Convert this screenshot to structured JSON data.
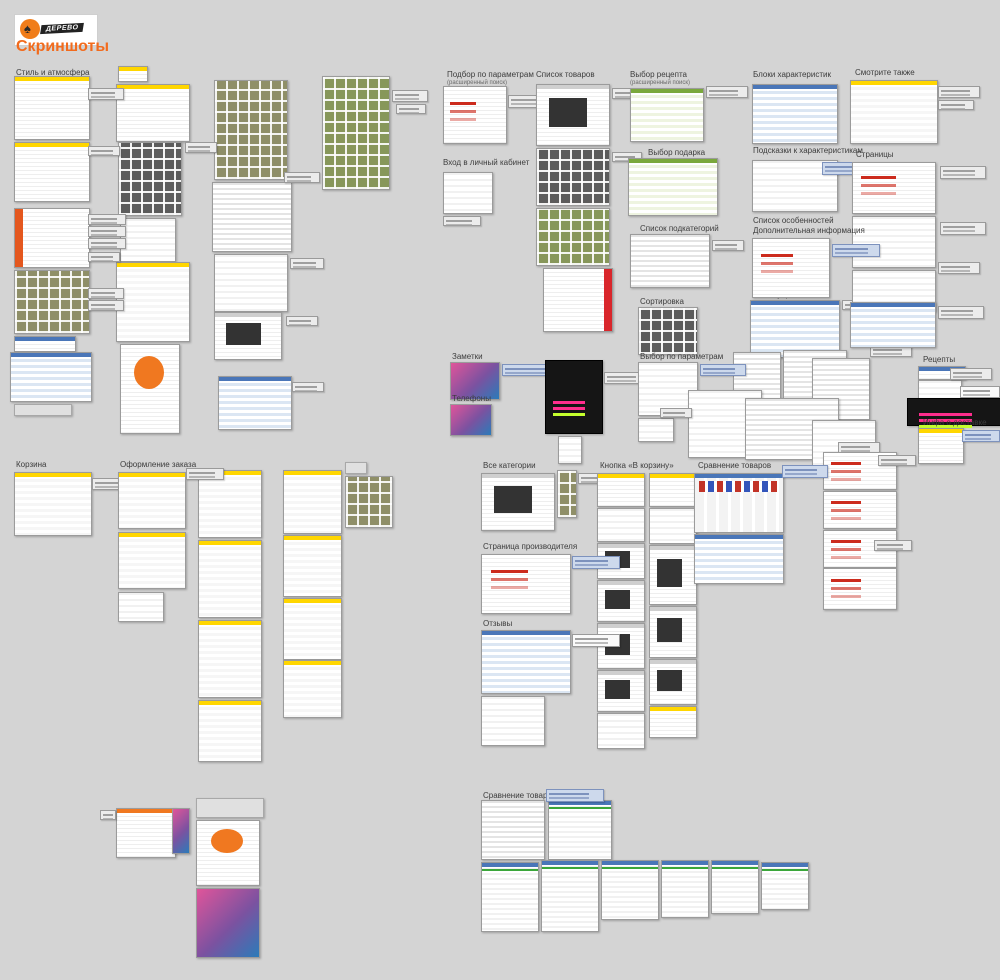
{
  "header": {
    "title": "Скриншоты",
    "logo": {
      "text": "ДЕРЕВО",
      "icon": "tree-icon"
    }
  },
  "colors": {
    "background": "#d4d4d4",
    "accent_orange": "#f26b1d",
    "yellow_header": "#ffd600",
    "blue_header": "#4a76b8",
    "green_banner": "#7aa83c",
    "note_gray": "#ececec",
    "note_blue": "#cdd9ec"
  },
  "groups": [
    {
      "id": "style",
      "label": "Стиль и атмосфера",
      "label_x": 16,
      "label_y": 68,
      "thumbs": [
        [
          14,
          76,
          74,
          62,
          "y"
        ],
        [
          14,
          142,
          74,
          58,
          "y"
        ],
        [
          14,
          208,
          74,
          58,
          "rbl"
        ],
        [
          14,
          270,
          74,
          62,
          "g"
        ],
        [
          14,
          336,
          60,
          14,
          "b"
        ],
        [
          10,
          352,
          80,
          48,
          "bt"
        ],
        [
          14,
          404,
          56,
          10,
          "s"
        ],
        [
          118,
          66,
          28,
          14,
          "y"
        ],
        [
          116,
          84,
          72,
          56,
          "y"
        ],
        [
          118,
          142,
          62,
          72,
          "gp"
        ],
        [
          120,
          218,
          54,
          42,
          "w"
        ],
        [
          116,
          262,
          72,
          78,
          "yl"
        ],
        [
          120,
          344,
          58,
          88,
          "ob"
        ],
        [
          214,
          80,
          72,
          98,
          "g"
        ],
        [
          212,
          182,
          78,
          68,
          "wt"
        ],
        [
          214,
          254,
          72,
          56,
          "w"
        ],
        [
          214,
          312,
          66,
          46,
          "d"
        ],
        [
          218,
          376,
          72,
          52,
          "bt"
        ],
        [
          322,
          76,
          66,
          112,
          "gt"
        ]
      ],
      "notes": [
        [
          88,
          88,
          34,
          10,
          "n"
        ],
        [
          88,
          146,
          30,
          8,
          "n"
        ],
        [
          88,
          214,
          36,
          9,
          "n"
        ],
        [
          88,
          226,
          36,
          9,
          "n"
        ],
        [
          88,
          238,
          36,
          9,
          "n"
        ],
        [
          88,
          252,
          30,
          8,
          "n"
        ],
        [
          88,
          288,
          34,
          9,
          "n"
        ],
        [
          88,
          300,
          34,
          9,
          "n"
        ],
        [
          185,
          142,
          30,
          9,
          "n"
        ],
        [
          284,
          172,
          34,
          9,
          "n"
        ],
        [
          290,
          258,
          32,
          9,
          "n"
        ],
        [
          286,
          316,
          30,
          8,
          "n"
        ],
        [
          292,
          382,
          30,
          8,
          "n"
        ],
        [
          392,
          90,
          34,
          10,
          "n"
        ],
        [
          396,
          104,
          28,
          8,
          "n"
        ]
      ]
    },
    {
      "id": "podbor",
      "label": "Подбор по параметрам",
      "sublabel": "(расширенный поиск)",
      "label_x": 447,
      "label_y": 70,
      "thumbs": [
        [
          443,
          86,
          62,
          56,
          "wr"
        ]
      ],
      "notes": [
        [
          508,
          95,
          42,
          11,
          "n"
        ]
      ]
    },
    {
      "id": "vhod",
      "label": "Вход в личный кабинет",
      "label_x": 443,
      "label_y": 158,
      "thumbs": [
        [
          443,
          172,
          48,
          40,
          "w"
        ]
      ],
      "notes": [
        [
          443,
          216,
          36,
          8,
          "n"
        ]
      ]
    },
    {
      "id": "zametki",
      "label": "Заметки",
      "label_x": 452,
      "label_y": 352,
      "thumbs": [
        [
          450,
          362,
          48,
          36,
          "c"
        ]
      ],
      "notes": [
        [
          502,
          364,
          56,
          10,
          "nb"
        ]
      ]
    },
    {
      "id": "telefony",
      "label": "Телефоны",
      "label_x": 452,
      "label_y": 394,
      "thumbs": [
        [
          450,
          404,
          40,
          30,
          "c"
        ],
        [
          545,
          360,
          56,
          72,
          "k"
        ],
        [
          558,
          436,
          22,
          26,
          "w"
        ]
      ],
      "notes": [
        [
          604,
          372,
          40,
          10,
          "n"
        ]
      ]
    },
    {
      "id": "spisok_tovarov",
      "label": "Список товаров",
      "label_x": 536,
      "label_y": 70,
      "thumbs": [
        [
          536,
          84,
          72,
          60,
          "d"
        ],
        [
          536,
          148,
          72,
          56,
          "gp"
        ],
        [
          536,
          208,
          72,
          56,
          "gt"
        ],
        [
          543,
          268,
          68,
          62,
          "rbr"
        ]
      ],
      "notes": [
        [
          612,
          88,
          30,
          9,
          "n"
        ],
        [
          612,
          152,
          28,
          8,
          "n"
        ]
      ]
    },
    {
      "id": "vybor_recepta",
      "label": "Выбор рецепта",
      "sublabel": "(расширенный поиск)",
      "label_x": 630,
      "label_y": 70,
      "thumbs": [
        [
          630,
          88,
          72,
          52,
          "gr"
        ]
      ],
      "notes": [
        [
          706,
          86,
          40,
          10,
          "n"
        ]
      ]
    },
    {
      "id": "vybor_podarka",
      "label": "Выбор подарка",
      "label_x": 648,
      "label_y": 148,
      "thumbs": [
        [
          628,
          158,
          88,
          56,
          "gr"
        ]
      ],
      "notes": []
    },
    {
      "id": "spisok_podkategorij",
      "label": "Список подкатегорий",
      "label_x": 640,
      "label_y": 224,
      "thumbs": [
        [
          630,
          234,
          78,
          52,
          "wt"
        ]
      ],
      "notes": [
        [
          712,
          240,
          30,
          9,
          "n"
        ]
      ]
    },
    {
      "id": "sortirovka",
      "label": "Сортировка",
      "label_x": 640,
      "label_y": 297,
      "thumbs": [
        [
          638,
          307,
          58,
          46,
          "gp"
        ]
      ],
      "notes": []
    },
    {
      "id": "aksessuary",
      "label": "Аксессуары",
      "label_x": 752,
      "label_y": 290,
      "thumbs": [
        [
          750,
          300,
          88,
          56,
          "bt"
        ]
      ],
      "notes": [
        [
          842,
          300,
          28,
          8,
          "n"
        ]
      ]
    },
    {
      "id": "vybor_po_parametram",
      "label": "Выбор по параметрам",
      "label_x": 640,
      "label_y": 352,
      "thumbs": [
        [
          638,
          362,
          58,
          52,
          "w"
        ],
        [
          638,
          418,
          34,
          22,
          "w"
        ],
        [
          733,
          352,
          46,
          62,
          "wt"
        ],
        [
          783,
          350,
          62,
          55,
          "wt"
        ],
        [
          812,
          358,
          56,
          60,
          "wt"
        ],
        [
          688,
          390,
          72,
          66,
          "w"
        ],
        [
          745,
          398,
          92,
          60,
          "wt"
        ],
        [
          812,
          420,
          62,
          46,
          "w"
        ]
      ],
      "notes": [
        [
          700,
          364,
          44,
          10,
          "nb"
        ],
        [
          660,
          408,
          30,
          8,
          "n"
        ],
        [
          870,
          345,
          40,
          10,
          "n"
        ],
        [
          838,
          442,
          40,
          10,
          "n"
        ]
      ]
    },
    {
      "id": "bloki_harakteristik",
      "label": "Блоки характеристик",
      "label_x": 753,
      "label_y": 70,
      "thumbs": [
        [
          752,
          84,
          84,
          58,
          "bt"
        ]
      ],
      "notes": []
    },
    {
      "id": "smotrite_takzhe",
      "label": "Смотрите также",
      "label_x": 855,
      "label_y": 68,
      "thumbs": [
        [
          850,
          80,
          86,
          62,
          "yl"
        ]
      ],
      "notes": [
        [
          938,
          86,
          40,
          10,
          "n"
        ],
        [
          938,
          100,
          34,
          8,
          "n"
        ]
      ]
    },
    {
      "id": "podskazki",
      "label": "Подсказки к характеристикам",
      "label_x": 753,
      "label_y": 146,
      "thumbs": [
        [
          752,
          160,
          84,
          50,
          "w"
        ]
      ],
      "notes": [
        [
          822,
          162,
          46,
          11,
          "nb"
        ]
      ]
    },
    {
      "id": "stranicy",
      "label": "Страницы",
      "label_x": 856,
      "label_y": 150,
      "thumbs": [
        [
          852,
          162,
          82,
          50,
          "wr"
        ],
        [
          852,
          216,
          82,
          50,
          "w"
        ],
        [
          852,
          270,
          82,
          40,
          "w"
        ],
        [
          850,
          302,
          84,
          44,
          "bt"
        ]
      ],
      "notes": [
        [
          940,
          166,
          44,
          11,
          "n"
        ],
        [
          940,
          222,
          44,
          11,
          "n"
        ],
        [
          938,
          262,
          40,
          10,
          "n"
        ],
        [
          938,
          306,
          44,
          11,
          "n"
        ]
      ]
    },
    {
      "id": "spisok_osobennostej",
      "label": "Список особенностей",
      "label2": "Дополнительная информация",
      "label_x": 753,
      "label_y": 216,
      "thumbs": [
        [
          752,
          238,
          76,
          58,
          "wr"
        ]
      ],
      "notes": [
        [
          832,
          244,
          46,
          11,
          "nb"
        ]
      ]
    },
    {
      "id": "recepty",
      "label": "Рецепты",
      "label_x": 923,
      "label_y": 355,
      "thumbs": [
        [
          918,
          366,
          46,
          12,
          "b"
        ],
        [
          918,
          380,
          42,
          46,
          "w"
        ],
        [
          907,
          398,
          92,
          26,
          "k"
        ]
      ],
      "notes": [
        [
          950,
          368,
          40,
          10,
          "n"
        ],
        [
          960,
          386,
          38,
          10,
          "nw"
        ]
      ]
    },
    {
      "id": "infa_o_dostavke",
      "label": "Инфа о доставке",
      "label_x": 923,
      "label_y": 418,
      "thumbs": [
        [
          918,
          428,
          44,
          34,
          "y"
        ]
      ],
      "notes": [
        [
          962,
          430,
          36,
          10,
          "nb"
        ]
      ]
    },
    {
      "id": "korzina",
      "label": "Корзина",
      "label_x": 16,
      "label_y": 460,
      "thumbs": [
        [
          14,
          472,
          76,
          62,
          "yl"
        ]
      ],
      "notes": [
        [
          92,
          478,
          40,
          10,
          "n"
        ]
      ]
    },
    {
      "id": "oformlenie_zakaza",
      "label": "Оформление заказа",
      "label_x": 120,
      "label_y": 460,
      "thumbs": [
        [
          118,
          472,
          66,
          55,
          "yl"
        ],
        [
          118,
          532,
          66,
          55,
          "yl"
        ],
        [
          118,
          592,
          44,
          28,
          "w"
        ],
        [
          198,
          470,
          62,
          66,
          "yl"
        ],
        [
          198,
          540,
          62,
          76,
          "yl"
        ],
        [
          198,
          620,
          62,
          76,
          "yl"
        ],
        [
          198,
          700,
          62,
          60,
          "yl"
        ],
        [
          283,
          470,
          57,
          62,
          "yl"
        ],
        [
          283,
          535,
          57,
          60,
          "yl"
        ],
        [
          283,
          598,
          57,
          60,
          "yl"
        ],
        [
          283,
          660,
          57,
          56,
          "yl"
        ],
        [
          345,
          462,
          20,
          10,
          "s"
        ],
        [
          345,
          476,
          46,
          50,
          "g"
        ],
        [
          116,
          808,
          58,
          48,
          "o"
        ],
        [
          172,
          808,
          16,
          44,
          "c"
        ],
        [
          196,
          798,
          66,
          18,
          "s"
        ],
        [
          196,
          820,
          62,
          64,
          "ob"
        ],
        [
          196,
          888,
          62,
          68,
          "c"
        ]
      ],
      "notes": [
        [
          186,
          468,
          36,
          10,
          "n"
        ],
        [
          100,
          810,
          14,
          8,
          "n"
        ]
      ]
    },
    {
      "id": "vse_kategorii",
      "label": "Все категории",
      "label_x": 483,
      "label_y": 461,
      "thumbs": [
        [
          481,
          473,
          72,
          56,
          "d"
        ],
        [
          557,
          470,
          18,
          46,
          "g"
        ]
      ],
      "notes": [
        [
          578,
          473,
          28,
          9,
          "n"
        ]
      ]
    },
    {
      "id": "knopka_v_korzinu",
      "label": "Кнопка «В корзину»",
      "label_x": 600,
      "label_y": 461,
      "thumbs": [
        [
          597,
          473,
          46,
          32,
          "y"
        ],
        [
          597,
          508,
          46,
          32,
          "w"
        ],
        [
          597,
          543,
          46,
          34,
          "d"
        ],
        [
          597,
          580,
          46,
          40,
          "d"
        ],
        [
          597,
          623,
          46,
          44,
          "d"
        ],
        [
          597,
          670,
          46,
          40,
          "d"
        ],
        [
          597,
          713,
          46,
          34,
          "w"
        ],
        [
          649,
          473,
          46,
          32,
          "y"
        ],
        [
          649,
          508,
          46,
          34,
          "w"
        ],
        [
          649,
          545,
          46,
          58,
          "d"
        ],
        [
          649,
          606,
          46,
          50,
          "d"
        ],
        [
          649,
          659,
          46,
          44,
          "d"
        ],
        [
          649,
          706,
          46,
          30,
          "y"
        ]
      ],
      "notes": []
    },
    {
      "id": "sravnenie_tovarov_1",
      "label": "Сравнение товаров",
      "label_x": 698,
      "label_y": 461,
      "thumbs": [
        [
          694,
          473,
          88,
          58,
          "cmp"
        ],
        [
          694,
          534,
          88,
          48,
          "bt"
        ],
        [
          823,
          452,
          72,
          36,
          "wr"
        ],
        [
          823,
          491,
          72,
          36,
          "wr"
        ],
        [
          823,
          530,
          72,
          36,
          "wr"
        ],
        [
          823,
          568,
          72,
          40,
          "wr"
        ]
      ],
      "notes": [
        [
          782,
          465,
          44,
          11,
          "nb"
        ],
        [
          878,
          455,
          36,
          9,
          "n"
        ],
        [
          874,
          540,
          36,
          9,
          "n"
        ]
      ]
    },
    {
      "id": "stranica_proizvoditelya",
      "label": "Страница производителя",
      "label_x": 483,
      "label_y": 542,
      "thumbs": [
        [
          481,
          554,
          88,
          58,
          "wr"
        ]
      ],
      "notes": [
        [
          572,
          556,
          46,
          11,
          "nb"
        ]
      ]
    },
    {
      "id": "otzyvy",
      "label": "Отзывы",
      "label_x": 483,
      "label_y": 619,
      "thumbs": [
        [
          481,
          630,
          88,
          62,
          "bt"
        ],
        [
          481,
          696,
          62,
          48,
          "w"
        ]
      ],
      "notes": [
        [
          572,
          634,
          46,
          11,
          "nw"
        ]
      ]
    },
    {
      "id": "sravnenie_tovarov_2",
      "label": "Сравнение товаров",
      "label_x": 483,
      "label_y": 791,
      "thumbs": [
        [
          481,
          800,
          62,
          58,
          "wt"
        ],
        [
          548,
          800,
          62,
          58,
          "vg"
        ],
        [
          481,
          862,
          56,
          68,
          "vg"
        ],
        [
          541,
          860,
          56,
          70,
          "vg"
        ],
        [
          601,
          860,
          56,
          58,
          "vg"
        ],
        [
          661,
          860,
          46,
          56,
          "vg"
        ],
        [
          711,
          860,
          46,
          52,
          "vg"
        ],
        [
          761,
          862,
          46,
          46,
          "vg"
        ]
      ],
      "notes": [
        [
          546,
          789,
          56,
          11,
          "nb"
        ]
      ]
    }
  ]
}
